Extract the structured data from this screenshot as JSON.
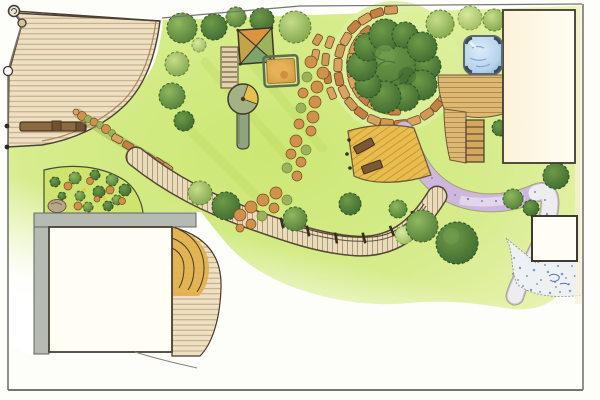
{
  "drawing": {
    "description": "Hand-drawn garden landscape plan, top view, watercolor and marker style"
  },
  "palette": {
    "paper": "#fdfdf9",
    "line": "#4a4034",
    "boundary": "#77766e",
    "deck_wood": "#eee0c2",
    "deck_line": "#a8885e",
    "deck_gold": "#e8bd4e",
    "deck_gold_line": "#bd8f33",
    "wood_mid": "#dcb873",
    "wood_mid_line": "#a57a3f",
    "lawn_bright": "#cbe873",
    "lawn_mid": "#dff0a0",
    "lawn_pale": "#f3f8dd",
    "halo_green": "#dcee9b",
    "tree_dark1": "#6e9a48",
    "tree_dark2": "#3e6a31",
    "tree_mid1": "#8fb85f",
    "tree_mid2": "#537d38",
    "tree_light1": "#c6dd8a",
    "tree_light2": "#7fa449",
    "tree_pale1": "#d8e9a2",
    "tree_pale2": "#9cbb5e",
    "shrub_orange1": "#d0914d",
    "shrub_orange2": "#a86428",
    "shrub_line": "#7a4a20",
    "shrub_olive1": "#9cb35c",
    "shrub_olive2": "#6d8a3a",
    "stone_tan": "#d9a45f",
    "stone_mid": "#cf9a55",
    "stone_deep": "#c58045",
    "stone_line": "#6b4a26",
    "path_purple": "#cdb7dd",
    "path_purple_deep": "#9a7fb5",
    "path_white": "#ededf0",
    "pebble_blue": "#7d9cc4",
    "water_light": "#dcebf6",
    "water_blue": "#9fc3e4",
    "water_line": "#5a6a74",
    "cream": "#fbf2d8",
    "cream_light": "#fffdf4",
    "wall_gray": "#b5bab3",
    "bench_wood": "#8a6a3f",
    "bench_dark": "#4a3520",
    "sand1": "#f0c266",
    "sand2": "#d6993f",
    "canopy_n": "#dd9440",
    "canopy_e": "#9cb35c",
    "canopy_s": "#7aa56b",
    "canopy_w": "#c4a44a"
  },
  "features": {
    "deck_terrace": "wooden deck terrace",
    "fence": "boundary fence with turned posts",
    "bench": "deck bench",
    "lawn": "lawn",
    "flower_bed": "perennial flower bed with boulder",
    "garage": "outbuilding with gray walls",
    "house": "main house",
    "outbuilding": "garden pavilion slab",
    "play_ladder": "play ladder",
    "climbing_frame": "climbing frame with canopy sail",
    "sandbox": "sandbox",
    "carousel": "roundabout with slide chute",
    "shrub_drift": "drift of flowering shrubs",
    "flagstone_path": "flagstone path around tree",
    "big_tree": "large specimen tree",
    "gold_deck": "sun deck with benches",
    "boardwalk": "boardwalk with rope railing",
    "gravel_path": "lilac gravel path",
    "stream": "dry pebble stream bed",
    "hot_tub": "hot tub on deck",
    "steps": "garden steps",
    "trees": "trees and shrubs"
  }
}
